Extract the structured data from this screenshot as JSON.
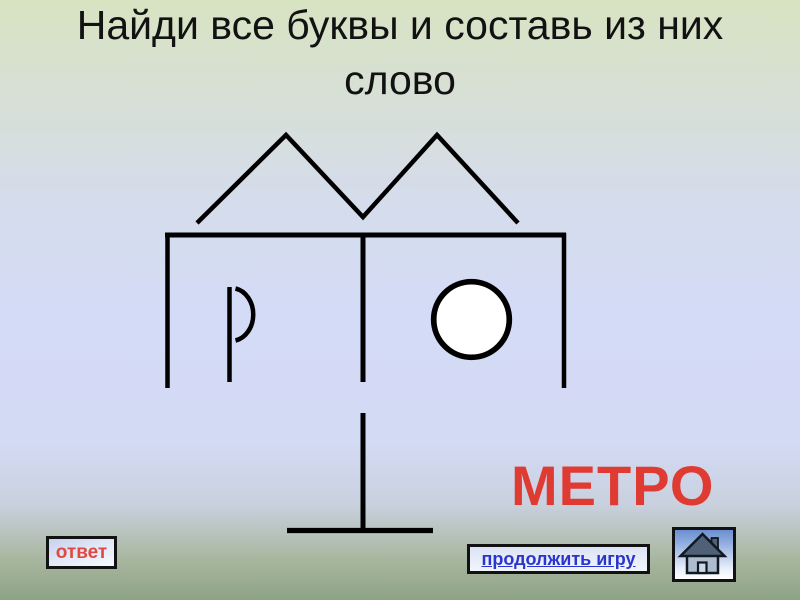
{
  "title": {
    "line1": "Найди все буквы и составь из них",
    "line2": "слово"
  },
  "puzzle": {
    "answer_word": "МЕТРО",
    "figure_hidden_letters": [
      "М",
      "Е",
      "Т",
      "Р",
      "О"
    ]
  },
  "buttons": {
    "answer_label": "ответ",
    "continue_label": "продолжить игру",
    "home_icon": "house-icon"
  },
  "colors": {
    "answer_word_red": "#df3b33",
    "answer_button_text_red": "#df4a44",
    "continue_link_blue": "#2a35cd",
    "title_text": "#121212",
    "figure_stroke": "#000000",
    "background_top_green": "#d8e3c2",
    "background_middle_lavender": "#d4dbf6",
    "background_bottom_green": "#8ea385"
  }
}
